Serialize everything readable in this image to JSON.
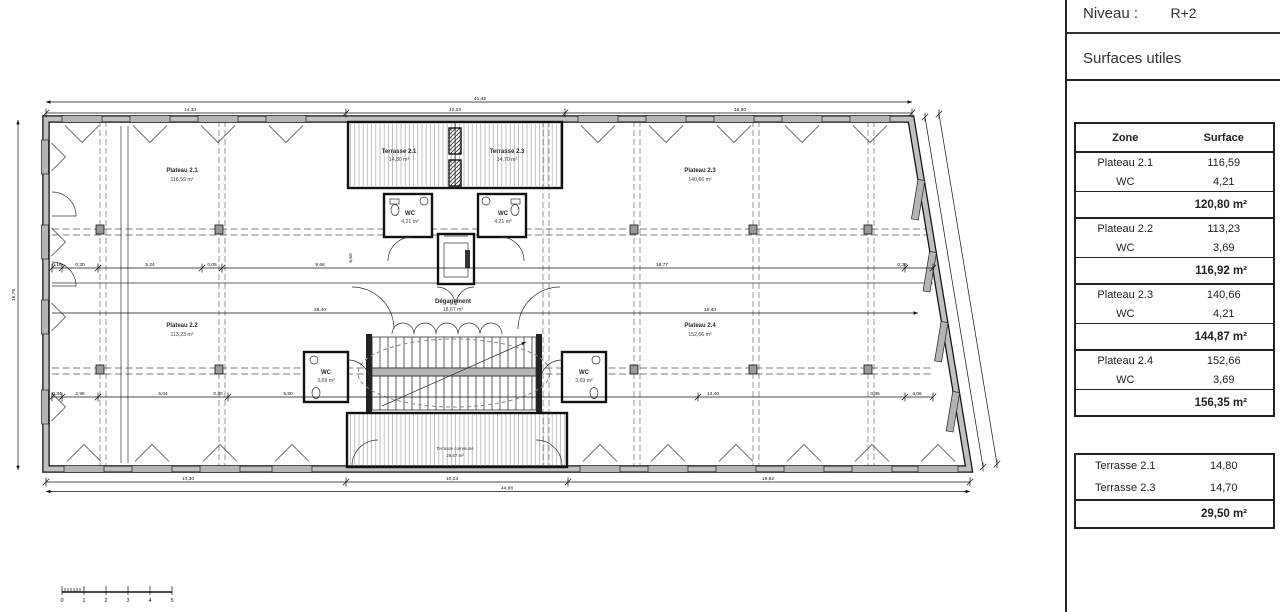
{
  "panel": {
    "niveau_label": "Niveau :",
    "niveau_value": "R+2",
    "subtitle": "Surfaces utiles",
    "table": {
      "col_zone": "Zone",
      "col_surface": "Surface",
      "groups": [
        {
          "zone": "Plateau 2.1",
          "surface": "116,59",
          "wc_label": "WC",
          "wc_surface": "4,21",
          "subtotal": "120,80 m²"
        },
        {
          "zone": "Plateau 2.2",
          "surface": "113,23",
          "wc_label": "WC",
          "wc_surface": "3,69",
          "subtotal": "116,92 m²"
        },
        {
          "zone": "Plateau 2.3",
          "surface": "140,66",
          "wc_label": "WC",
          "wc_surface": "4,21",
          "subtotal": "144,87 m²"
        },
        {
          "zone": "Plateau 2.4",
          "surface": "152,66",
          "wc_label": "WC",
          "wc_surface": "3,69",
          "subtotal": "156,35 m²"
        }
      ]
    },
    "terrasses": {
      "rows": [
        {
          "zone": "Terrasse 2.1",
          "surface": "14,80"
        },
        {
          "zone": "Terrasse 2.3",
          "surface": "14,70"
        }
      ],
      "total": "29,50 m²"
    }
  },
  "plan": {
    "rooms": {
      "plateau21": {
        "name": "Plateau 2.1",
        "area": "116,59 m²"
      },
      "plateau22": {
        "name": "Plateau 2.2",
        "area": "113,23 m²"
      },
      "plateau23": {
        "name": "Plateau 2.3",
        "area": "140,66 m²"
      },
      "plateau24": {
        "name": "Plateau 2.4",
        "area": "152,66 m²"
      },
      "terrasse21": {
        "name": "Terrasse 2.1",
        "area": "14,80 m²"
      },
      "terrasse23": {
        "name": "Terrasse 2.3",
        "area": "14,70 m²"
      },
      "wc_top_left": {
        "name": "WC",
        "area": "4,21 m²"
      },
      "wc_top_right": {
        "name": "WC",
        "area": "4,21 m²"
      },
      "wc_mid_left": {
        "name": "WC",
        "area": "3,69 m²"
      },
      "wc_mid_right": {
        "name": "WC",
        "area": "3,69 m²"
      },
      "degagement": {
        "name": "Dégagement",
        "area": "18,67 m²"
      },
      "toiture": {
        "name": "Terrasse commune",
        "area": "29,87 m²"
      }
    },
    "dims": {
      "top_overall": "41,42",
      "top_left": "14,30",
      "top_mid": "10,23",
      "top_right": "16,80",
      "mid_left": "26,40",
      "mid_right": "16,40",
      "bottom_left": "14,30",
      "bottom_mid": "10,23",
      "bottom_right": "19,82",
      "bottom_overall": "44,88",
      "left_overall": "16,76",
      "core_v": "6,60",
      "inner_top": [
        "0,16",
        "0,30",
        "5,24",
        "0,05",
        "9,66",
        "16,77",
        "0,30"
      ],
      "inner_bottom": [
        "0,34",
        "2,96",
        "5,04",
        "0,30",
        "5,80",
        "14,40",
        "0,35",
        "4,06"
      ]
    },
    "scalebar": [
      "0",
      "1",
      "2",
      "3",
      "4",
      "5"
    ]
  }
}
